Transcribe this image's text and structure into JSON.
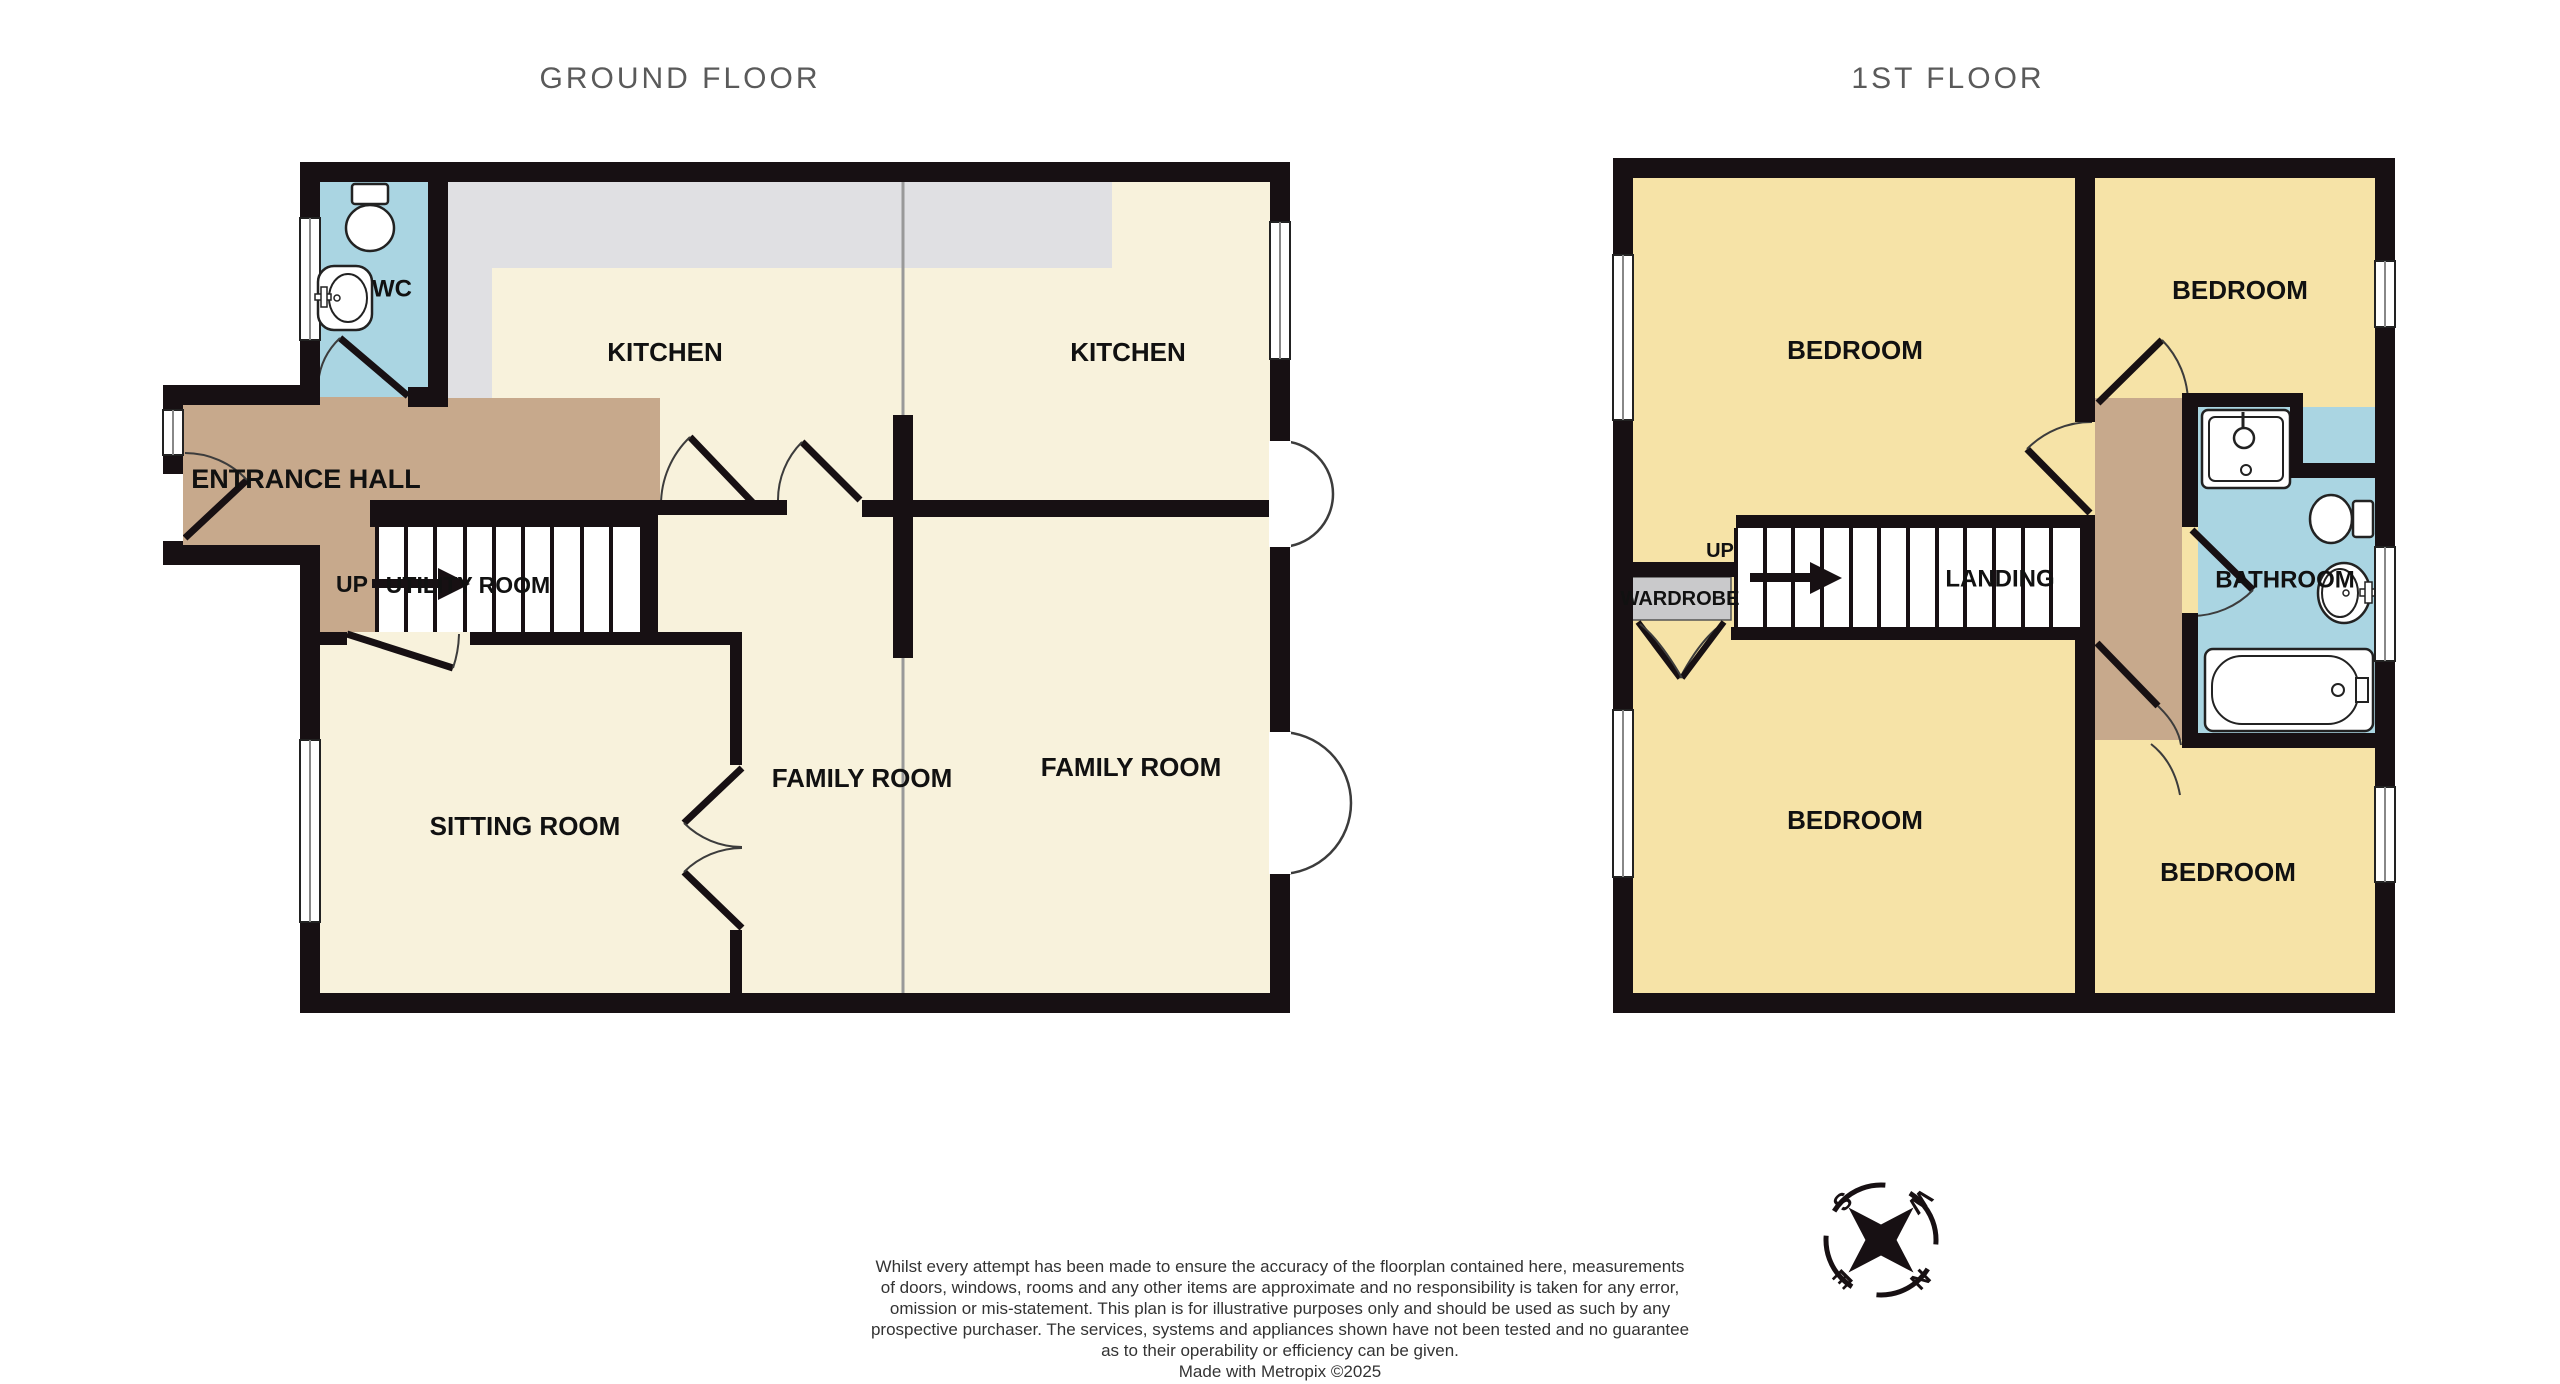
{
  "titles": {
    "ground": "GROUND FLOOR",
    "first": "1ST FLOOR"
  },
  "ground_floor": {
    "rooms": {
      "wc": "WC",
      "entrance_hall": "ENTRANCE HALL",
      "kitchen_left": "KITCHEN",
      "kitchen_right": "KITCHEN",
      "utility_room": "UTILITY ROOM",
      "sitting_room": "SITTING ROOM",
      "family_room_left": "FAMILY ROOM",
      "family_room_right": "FAMILY ROOM"
    },
    "stairs_direction": "UP"
  },
  "first_floor": {
    "rooms": {
      "bedroom_top_left": "BEDROOM",
      "bedroom_top_right": "BEDROOM",
      "bedroom_bottom_left": "BEDROOM",
      "bedroom_bottom_right": "BEDROOM",
      "landing": "LANDING",
      "wardrobe": "WARDROBE",
      "bathroom": "BATHROOM"
    },
    "stairs_direction": "UP"
  },
  "compass": {
    "n": "N",
    "e": "E",
    "s": "S",
    "w": "W"
  },
  "footer": {
    "lines": [
      "Whilst every attempt has been made to ensure the accuracy of the floorplan contained here, measurements",
      "of doors, windows, rooms and any other items are approximate and no responsibility is taken for any error,",
      "omission or mis-statement. This plan is for illustrative purposes only and should be used as such by any",
      "prospective purchaser. The services, systems and appliances shown have not been tested and no guarantee",
      "as to their operability or efficiency can be given.",
      "Made with Metropix ©2025"
    ]
  },
  "colors": {
    "wall": "#171013",
    "ground_room_fill": "#F8F2DC",
    "first_room_fill": "#F6E3A7",
    "wet_room_fill": "#AAD5E2",
    "hall_fill": "#C7A98C",
    "counter_fill": "#E0E0E3",
    "wardrobe_fill": "#C9C9CB",
    "title_text": "#5A5A5A",
    "label_text": "#111111",
    "party_line": "#999999"
  }
}
